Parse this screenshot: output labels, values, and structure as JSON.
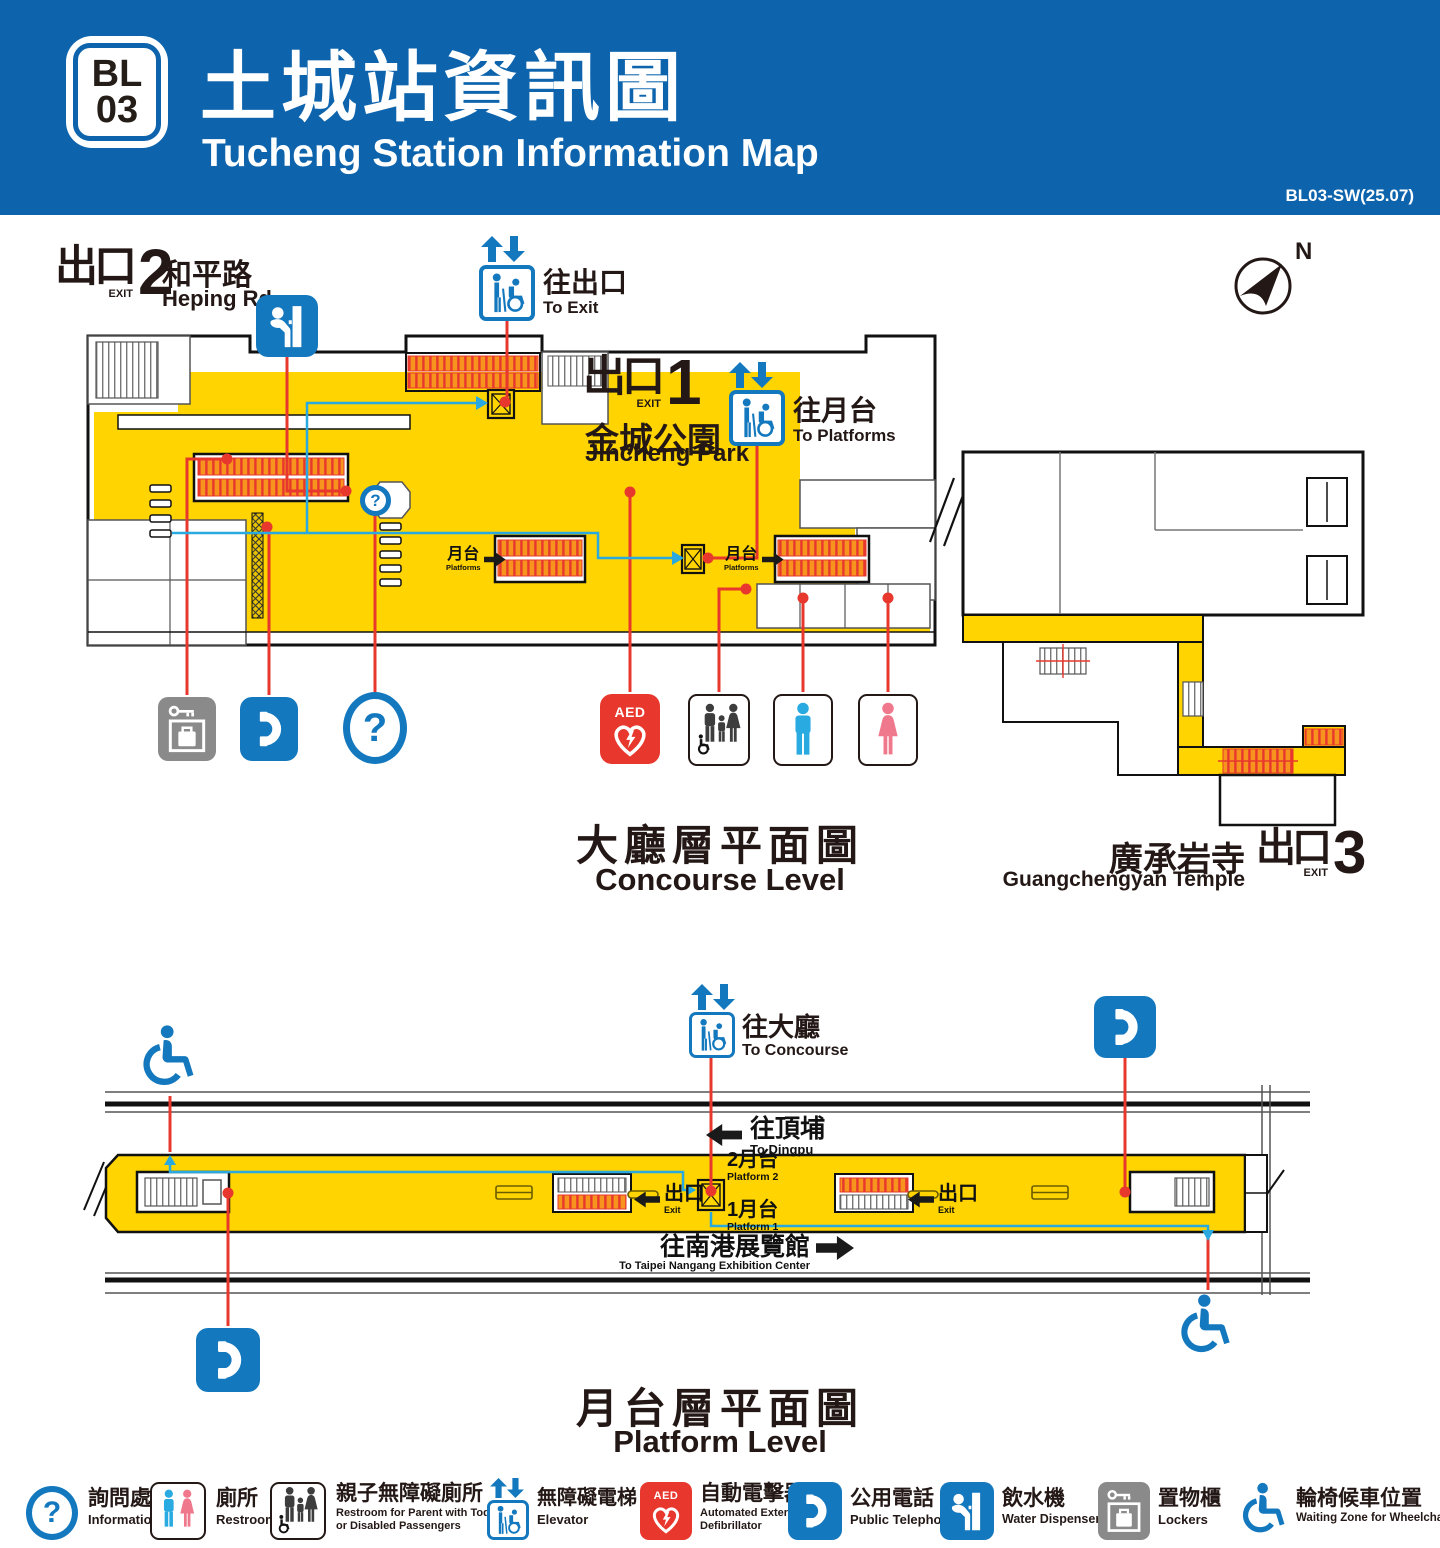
{
  "colors": {
    "header_blue": "#0d64ad",
    "map_yellow": "#ffd400",
    "icon_blue": "#1478be",
    "route_blue": "#29a9e0",
    "connector_red": "#e8382d",
    "male_blue": "#29abe2",
    "female_pink": "#f0788c",
    "locker_gray": "#8a8a8a",
    "text_dark": "#231815",
    "escalator_orange": "#f7941e"
  },
  "header": {
    "station_code_line1": "BL",
    "station_code_line2": "03",
    "title_zh": "土城站資訊圖",
    "title_en": "Tucheng Station Information Map",
    "version": "BL03-SW(25.07)"
  },
  "compass": {
    "north": "N"
  },
  "marks": {
    "question": "?",
    "aed": "AED"
  },
  "concourse": {
    "caption_zh": "大廳層平面圖",
    "caption_en": "Concourse Level",
    "exit2": {
      "zh": "出口",
      "en": "EXIT",
      "num": "2",
      "place_zh": "和平路",
      "place_en": "Heping Rd."
    },
    "exit1": {
      "zh": "出口",
      "en": "EXIT",
      "num": "1",
      "place_zh": "金城公園",
      "place_en": "Jincheng Park"
    },
    "exit3": {
      "zh": "出口",
      "en": "EXIT",
      "num": "3",
      "place_zh": "廣承岩寺",
      "place_en": "Guangchengyan Temple"
    },
    "to_exit": {
      "zh": "往出口",
      "en": "To Exit"
    },
    "to_platforms": {
      "zh": "往月台",
      "en": "To Platforms"
    },
    "platforms_marker": {
      "zh": "月台",
      "en": "Platforms"
    }
  },
  "platform": {
    "caption_zh": "月台層平面圖",
    "caption_en": "Platform Level",
    "to_concourse": {
      "zh": "往大廳",
      "en": "To Concourse"
    },
    "to_dingpu": {
      "zh": "往頂埔",
      "en": "To Dingpu"
    },
    "to_nangang": {
      "zh": "往南港展覽館",
      "en": "To Taipei Nangang Exhibition Center"
    },
    "platform2": {
      "zh": "2月台",
      "en": "Platform 2"
    },
    "platform1": {
      "zh": "1月台",
      "en": "Platform 1"
    },
    "exit_marker": {
      "zh": "出口",
      "en": "Exit"
    }
  },
  "legend": {
    "items": [
      {
        "icon": "information-icon",
        "zh": "詢問處",
        "en": "Information"
      },
      {
        "icon": "restroom-icon",
        "zh": "廁所",
        "en": "Restroom"
      },
      {
        "icon": "family-restroom-icon",
        "zh": "親子無障礙廁所",
        "en": "Restroom for Parent with Toddler or Disabled Passengers"
      },
      {
        "icon": "elevator-icon",
        "zh": "無障礙電梯",
        "en": "Elevator"
      },
      {
        "icon": "aed-icon",
        "zh": "自動電擊器",
        "en": "Automated External Defibrillator",
        "icon_text": "AED"
      },
      {
        "icon": "public-telephone-icon",
        "zh": "公用電話",
        "en": "Public Telephone"
      },
      {
        "icon": "water-dispenser-icon",
        "zh": "飲水機",
        "en": "Water Dispenser"
      },
      {
        "icon": "lockers-icon",
        "zh": "置物櫃",
        "en": "Lockers"
      },
      {
        "icon": "wheelchair-icon",
        "zh": "輪椅候車位置",
        "en": "Waiting Zone for Wheelchair"
      }
    ]
  }
}
